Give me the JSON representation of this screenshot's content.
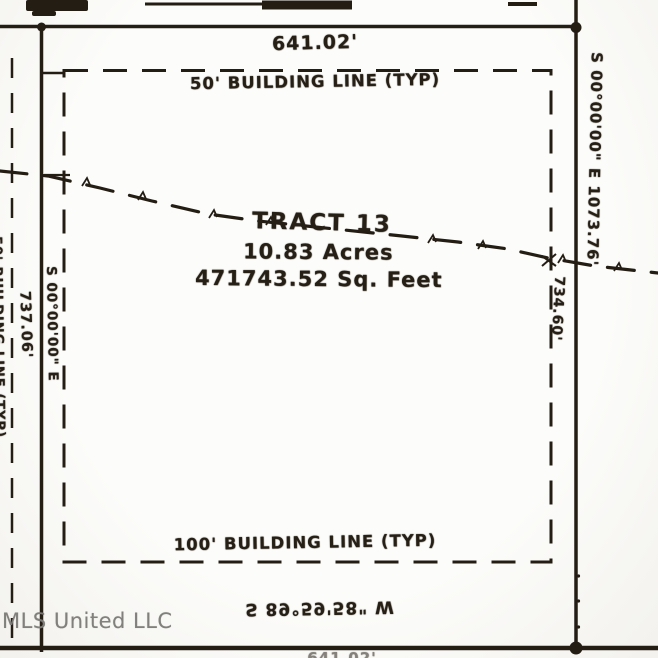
{
  "plat": {
    "north_line_distance": "641.02'",
    "building_line_top_label": "50' BUILDING LINE (TYP)",
    "building_line_bottom_label": "100' BUILDING LINE (TYP)",
    "building_line_left_clipped_label": "50' BUILDING LINE (TYP)",
    "tract": {
      "name": "TRACT 13",
      "acres": "10.83 Acres",
      "square_feet": "471743.52 Sq. Feet"
    },
    "east_line_bearing_distance": "S 00°00'00\" E 1073.76'",
    "east_line_partial_distance": "734.60'",
    "west_line_bearing": "S 00°00'00\" E",
    "west_line_distance": "737.06'",
    "south_line_bearing": "S 89°59'58\" W",
    "south_line_clipped_distance": "641.02'",
    "watermark": "MLS United LLC"
  },
  "colors": {
    "ink": "#241d14",
    "paper": "#fcfcfa",
    "watermark_gray": "#7d7c78"
  }
}
